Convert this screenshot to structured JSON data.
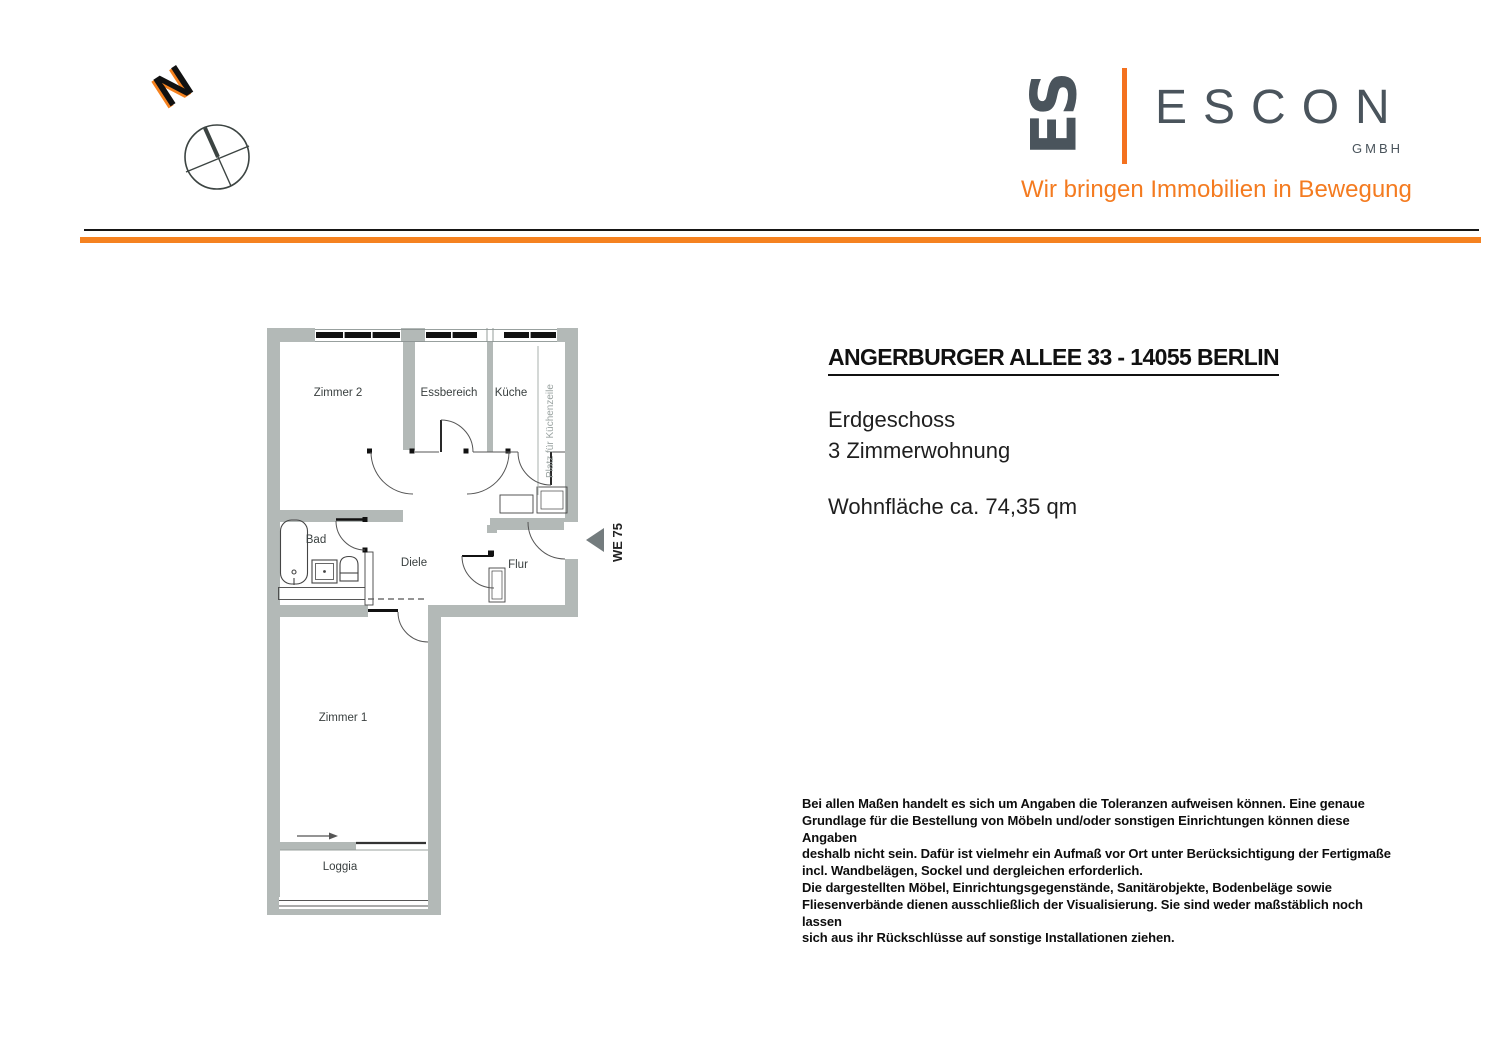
{
  "compass": {
    "n_label": "N"
  },
  "logo": {
    "monogram": "ES",
    "brand": "ESCON",
    "suffix": "GMBH",
    "tagline": "Wir bringen Immobilien in Bewegung",
    "brand_color": "#4a545c",
    "accent_color": "#f4711f"
  },
  "separator": {
    "dark_color": "#161616",
    "orange_color": "#f58220"
  },
  "property": {
    "title": "ANGERBURGER ALLEE 33 - 14055 BERLIN",
    "floor": "Erdgeschoss",
    "type": "3 Zimmerwohnung",
    "area": "Wohnfläche ca. 74,35 qm"
  },
  "floorplan": {
    "wall_color": "#b3b9b7",
    "unit": "WE 75",
    "rooms": {
      "zimmer2": "Zimmer 2",
      "essbereich": "Essbereich",
      "kueche": "Küche",
      "kuechenzeile": "Platz für Küchenzeile",
      "bad": "Bad",
      "diele": "Diele",
      "flur": "Flur",
      "zimmer1": "Zimmer 1",
      "loggia": "Loggia"
    }
  },
  "disclaimer": {
    "lines": [
      "Bei allen Maßen handelt es sich um Angaben die Toleranzen aufweisen können. Eine genaue",
      "Grundlage für die Bestellung von Möbeln und/oder sonstigen Einrichtungen können diese Angaben",
      "deshalb nicht sein. Dafür ist vielmehr ein Aufmaß vor Ort unter Berücksichtigung der Fertigmaße",
      "incl. Wandbelägen, Sockel und dergleichen erforderlich.",
      "Die dargestellten Möbel, Einrichtungsgegenstände, Sanitärobjekte, Bodenbeläge sowie",
      "Fliesenverbände dienen ausschließlich der Visualisierung. Sie sind weder maßstäblich noch lassen",
      "sich aus ihr Rückschlüsse auf sonstige Installationen ziehen."
    ]
  }
}
